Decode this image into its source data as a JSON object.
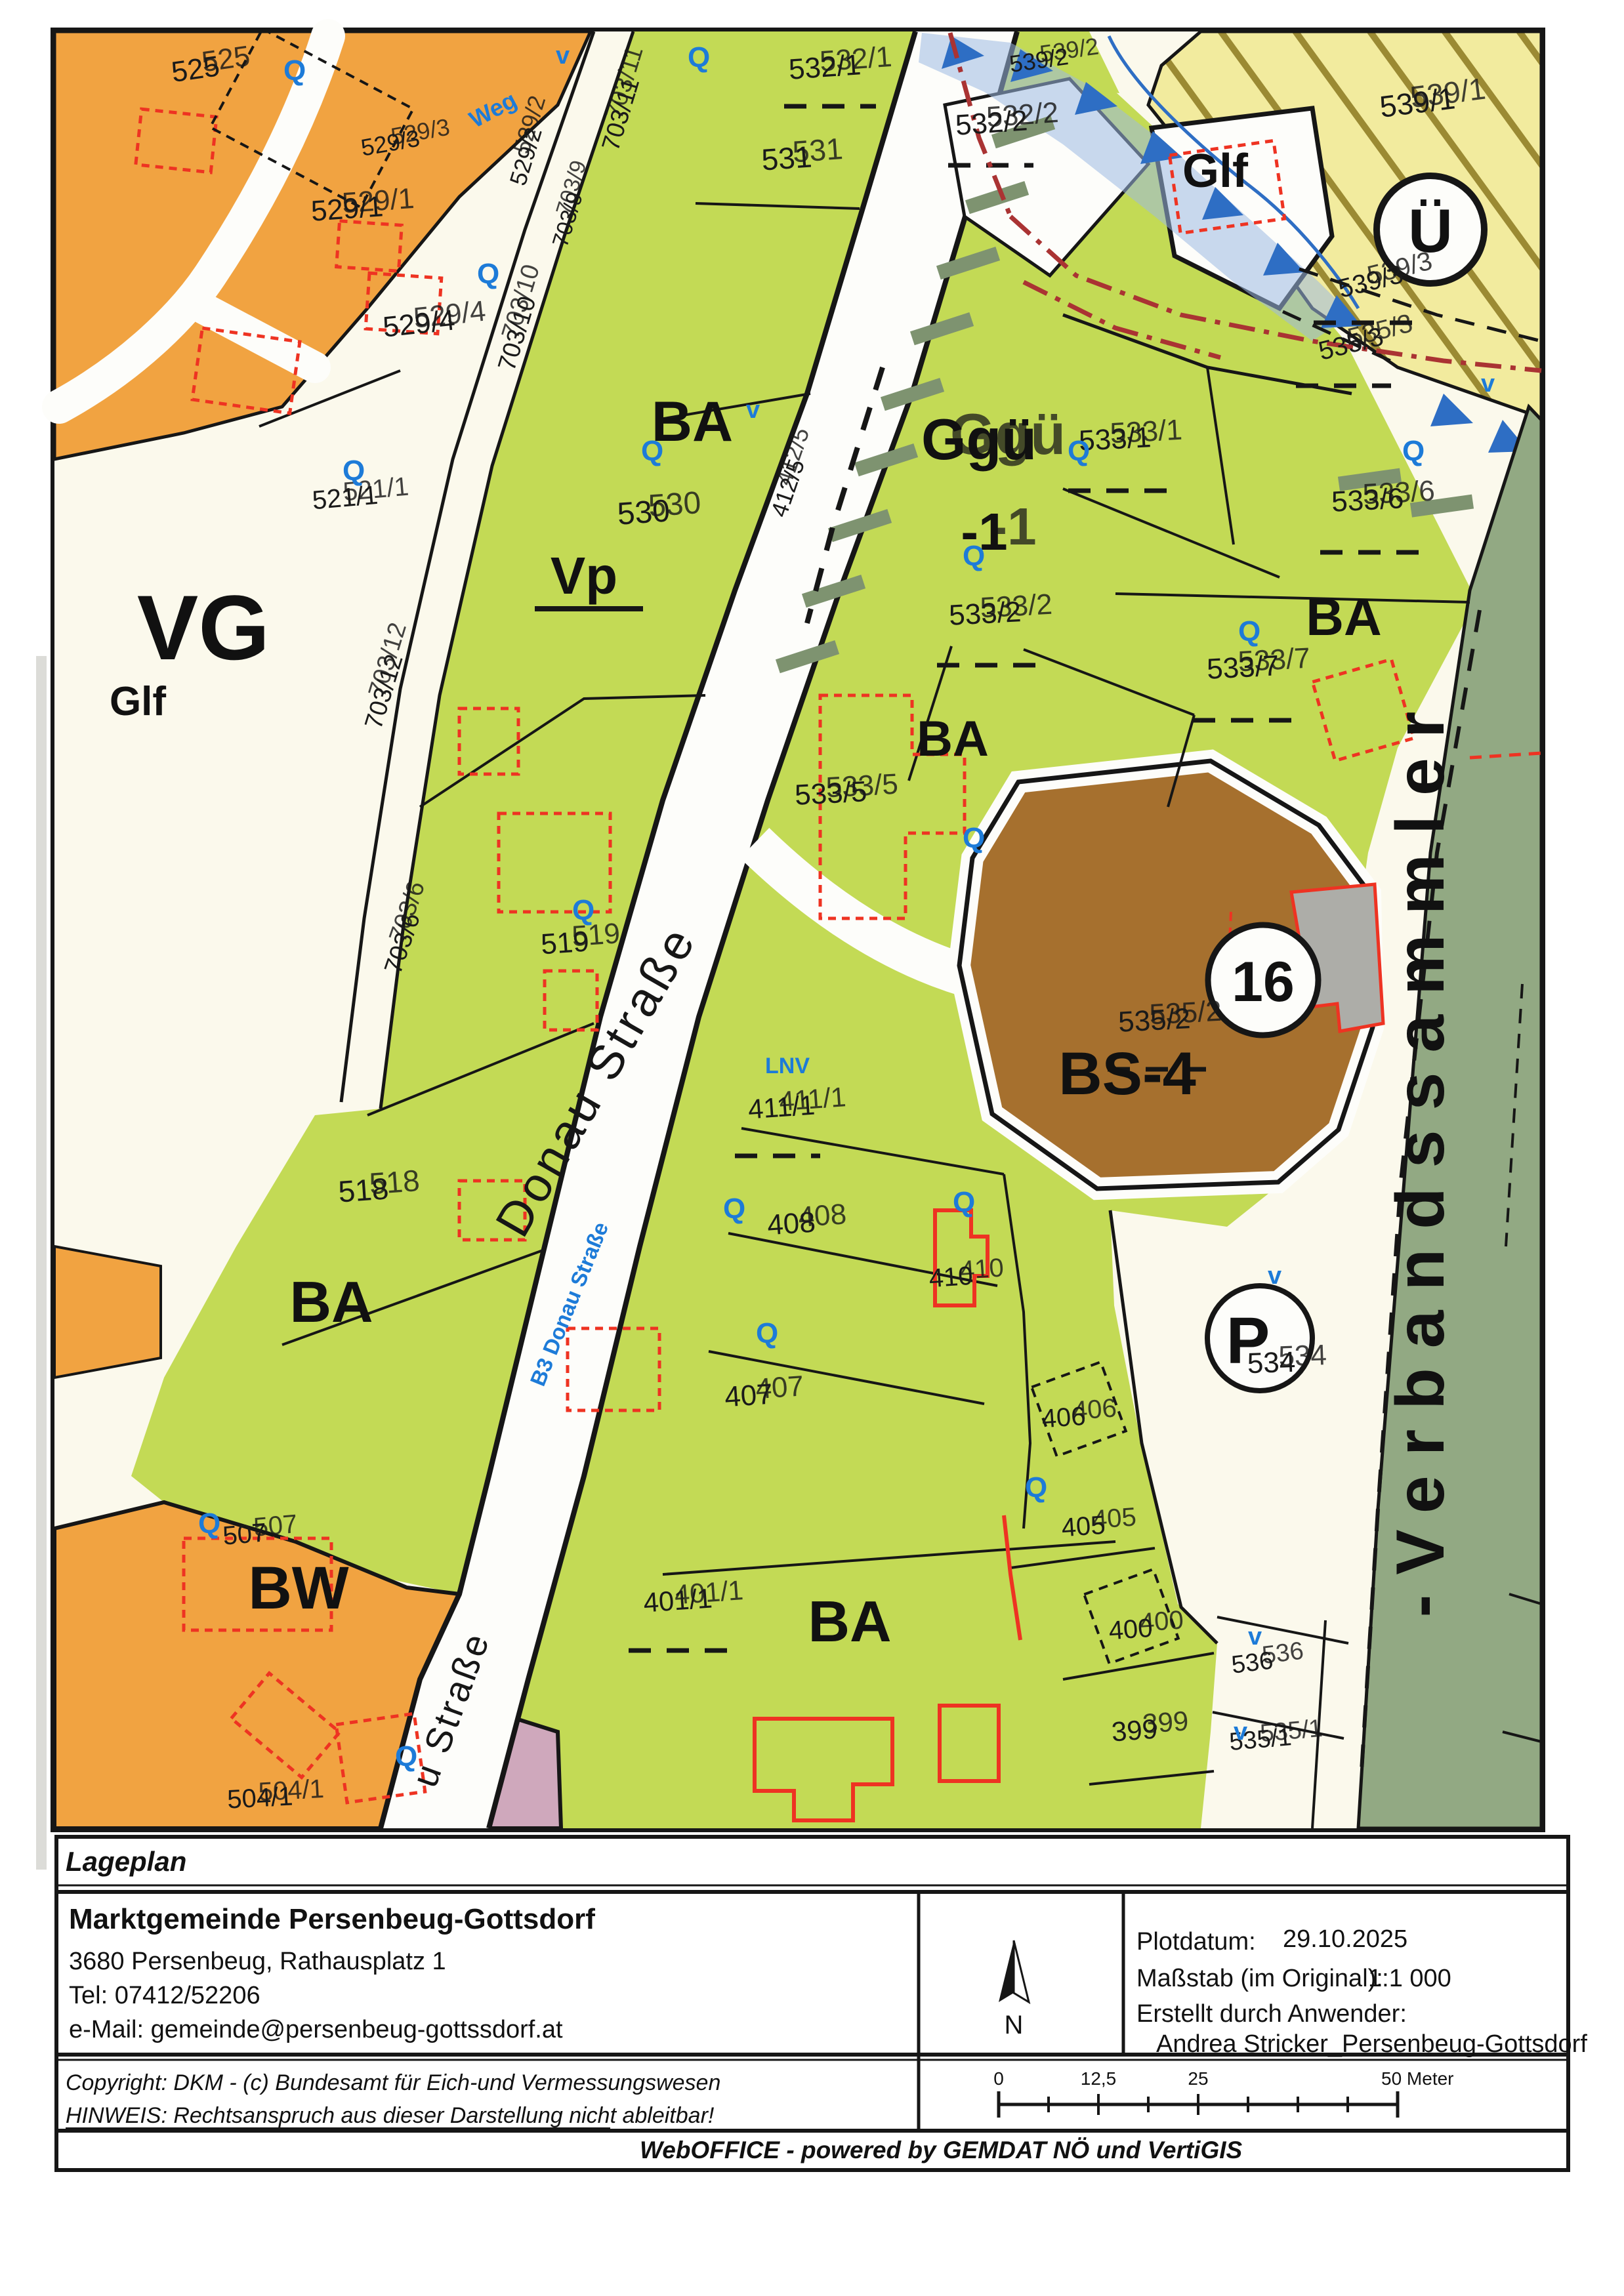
{
  "map": {
    "zones": {
      "ba": "BA",
      "vp": "Vp",
      "glf": "Glf",
      "ggue": "Ggü",
      "ggue_sub": "-1",
      "bs4": "BS-4",
      "bw": "BW",
      "vg": "VG",
      "ue": "Ü",
      "p": "P",
      "b16": "16",
      "lnv": "LNV"
    },
    "streets": {
      "donau": "Donau Straße",
      "b3": "B3 Donau Straße",
      "weg": "Weg",
      "lower": "u Straße",
      "collector": "-Verbandssammler"
    },
    "symbols": {
      "q": "Q",
      "v": "v"
    },
    "parcels": {
      "n525": "525",
      "n529_1": "529/1",
      "n529_2": "529/2",
      "n529_3": "529/3",
      "n529_4": "529/4",
      "n521_1": "521/1",
      "n530": "530",
      "n531": "531",
      "n532_1": "532/1",
      "n532_2": "532/2",
      "n539_1": "539/1",
      "n539_2": "539/2",
      "n539_3": "539/3",
      "n535_3": "535/3",
      "n533_1": "533/1",
      "n533_6": "533/6",
      "n533_2": "533/2",
      "n533_7": "533/7",
      "n533_5": "533/5",
      "n535_2": "535/2",
      "n519": "519",
      "n518": "518",
      "n412_5": "412/5",
      "n411_1": "411/1",
      "n408": "408",
      "n410": "410",
      "n407": "407",
      "n406": "406",
      "n405": "405",
      "n401_1": "401/1",
      "n400": "400",
      "n399": "399",
      "n534": "534",
      "n536": "536",
      "n535_1": "535/1",
      "n504_1": "504/1",
      "n507": "507",
      "n703_6": "703/6",
      "n703_9": "703/9",
      "n703_10": "703/10",
      "n703_11": "703/11",
      "n703_12": "703/12"
    },
    "palette": {
      "bauland_agrar_green": "#c3da55",
      "bauland_wohn_orange": "#f1a341",
      "sondergebiet_brown": "#a6702e",
      "gruenland_yellow": "#f2eb9e",
      "collector_sage": "#92a983",
      "water_blue": "#2e6ec4",
      "symbol_blue": "#1d7bd8",
      "building_red": "#ee3322",
      "pink": "#cfa8bc",
      "gray_building": "#adada8"
    }
  },
  "footer": {
    "lageplan": "Lageplan",
    "municipality": "Marktgemeinde Persenbeug-Gottsdorf",
    "address": "3680 Persenbeug, Rathausplatz 1",
    "phone": "Tel: 07412/52206",
    "email": "e-Mail: gemeinde@persenbeug-gottssdorf.at",
    "plotdatum_label": "Plotdatum:",
    "plotdatum_value": "29.10.2025",
    "massstab_label": "Maßstab (im Original):",
    "massstab_value": "1:1 000",
    "erstellt_label": "Erstellt durch Anwender:",
    "erstellt_value": "Andrea Stricker_Persenbeug-Gottsdorf",
    "north": "N",
    "copyright": "Copyright: DKM - (c) Bundesamt für Eich-und Vermessungswesen",
    "hinweis": "HINWEIS: Rechtsanspruch aus dieser Darstellung nicht ableitbar!",
    "weboffice": "WebOFFICE - powered by GEMDAT NÖ und VertiGIS"
  },
  "scalebar": {
    "labels": [
      "0",
      "12,5",
      "25",
      "50 Meter"
    ]
  }
}
